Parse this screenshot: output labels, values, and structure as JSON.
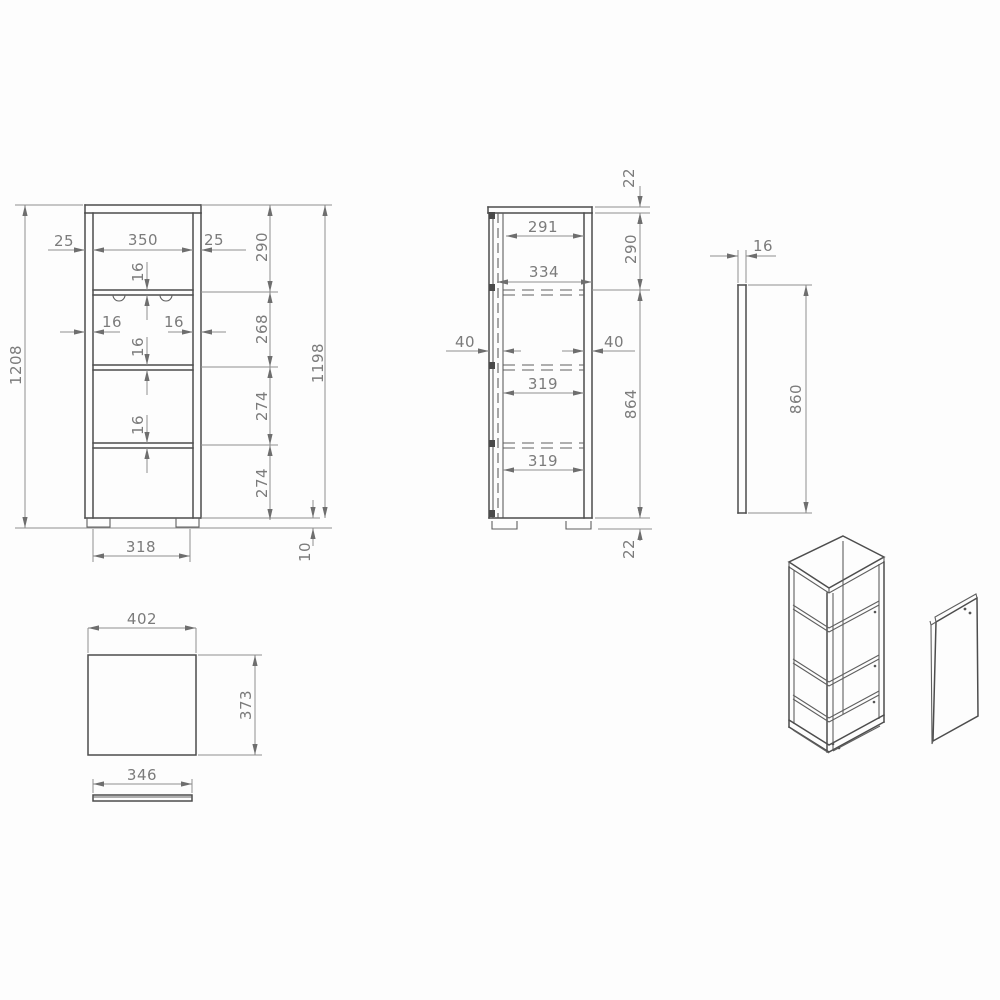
{
  "views": {
    "front": {
      "dims": {
        "total_height": "1208",
        "body_height": "1198",
        "overhang_left": "25",
        "inner_width": "350",
        "overhang_right": "25",
        "top_shelf_thickness": "16",
        "wall_left_thickness": "16",
        "wall_right_thickness": "16",
        "shelf2_thickness": "16",
        "shelf3_thickness": "16",
        "section_top": "290",
        "section_2": "268",
        "section_3": "274",
        "section_4": "274",
        "base_width": "318",
        "foot_height": "10"
      }
    },
    "side": {
      "dims": {
        "top_panel_thickness": "22",
        "depth_291": "291",
        "section_top": "290",
        "depth_334": "334",
        "setback_left": "40",
        "setback_right": "40",
        "depth_319a": "319",
        "mid_height": "864",
        "depth_319b": "319",
        "bottom_panel_thickness": "22"
      }
    },
    "back_panel": {
      "dims": {
        "thickness": "16",
        "height": "860"
      }
    },
    "top_view": {
      "dims": {
        "width": "402",
        "depth": "373"
      }
    },
    "plinth": {
      "dims": {
        "width": "346"
      }
    }
  }
}
